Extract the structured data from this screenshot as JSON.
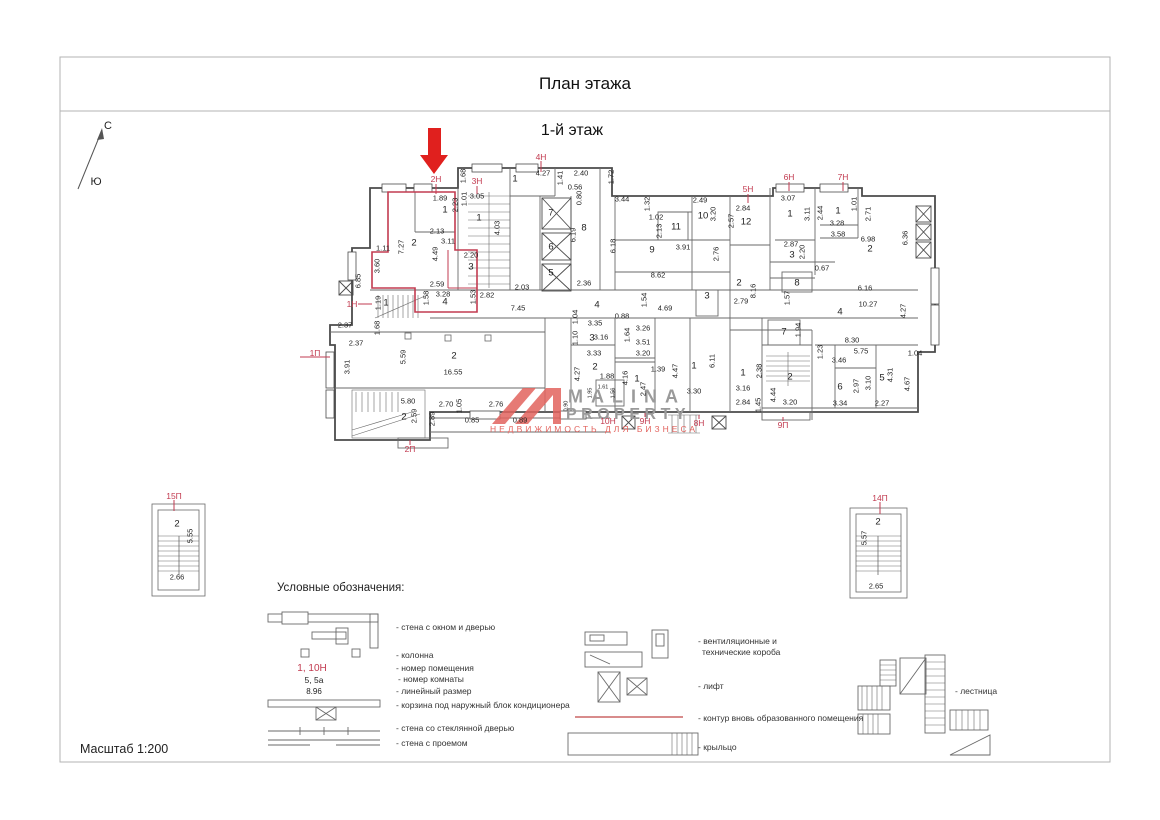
{
  "title": "План этажа",
  "floor_label": "1-й этаж",
  "scale_label": "Масштаб 1:200",
  "compass": {
    "north": "С",
    "south": "Ю"
  },
  "colors": {
    "highlight_red": "#c23b50",
    "wall": "#4b4b4b",
    "watermark_gray": "#9a9a9a",
    "watermark_red": "#e2635e"
  },
  "watermark": {
    "brand_top": "MALINA",
    "brand_bottom": "PROPERTY",
    "tagline": "НЕДВИЖИМОСТЬ ДЛЯ БИЗНЕСА"
  },
  "plan": {
    "unit_labels": [
      {
        "t": "2Н",
        "x": 436,
        "y": 179
      },
      {
        "t": "3Н",
        "x": 477,
        "y": 181
      },
      {
        "t": "4Н",
        "x": 541,
        "y": 157
      },
      {
        "t": "5Н",
        "x": 748,
        "y": 189
      },
      {
        "t": "6Н",
        "x": 789,
        "y": 177
      },
      {
        "t": "7Н",
        "x": 843,
        "y": 177
      },
      {
        "t": "1Н",
        "x": 352,
        "y": 304
      },
      {
        "t": "1П",
        "x": 315,
        "y": 353
      },
      {
        "t": "2П",
        "x": 410,
        "y": 449
      },
      {
        "t": "10Н",
        "x": 608,
        "y": 421
      },
      {
        "t": "9Н",
        "x": 645,
        "y": 421
      },
      {
        "t": "8Н",
        "x": 699,
        "y": 423
      },
      {
        "t": "9П",
        "x": 783,
        "y": 425
      },
      {
        "t": "15П",
        "x": 174,
        "y": 496
      },
      {
        "t": "14П",
        "x": 880,
        "y": 498
      }
    ],
    "room_numbers": [
      {
        "t": "1",
        "x": 445,
        "y": 210
      },
      {
        "t": "2",
        "x": 414,
        "y": 243
      },
      {
        "t": "3",
        "x": 471,
        "y": 267
      },
      {
        "t": "4",
        "x": 445,
        "y": 302
      },
      {
        "t": "1",
        "x": 479,
        "y": 218
      },
      {
        "t": "1",
        "x": 515,
        "y": 179
      },
      {
        "t": "7",
        "x": 551,
        "y": 213
      },
      {
        "t": "6",
        "x": 551,
        "y": 247
      },
      {
        "t": "5",
        "x": 551,
        "y": 273
      },
      {
        "t": "8",
        "x": 584,
        "y": 228
      },
      {
        "t": "9",
        "x": 652,
        "y": 250
      },
      {
        "t": "11",
        "x": 676,
        "y": 227
      },
      {
        "t": "10",
        "x": 703,
        "y": 216
      },
      {
        "t": "12",
        "x": 746,
        "y": 222
      },
      {
        "t": "1",
        "x": 790,
        "y": 214
      },
      {
        "t": "1",
        "x": 838,
        "y": 211
      },
      {
        "t": "2",
        "x": 870,
        "y": 249
      },
      {
        "t": "3",
        "x": 792,
        "y": 255
      },
      {
        "t": "8",
        "x": 797,
        "y": 283
      },
      {
        "t": "2",
        "x": 739,
        "y": 283
      },
      {
        "t": "4",
        "x": 597,
        "y": 305
      },
      {
        "t": "3",
        "x": 592,
        "y": 338
      },
      {
        "t": "2",
        "x": 595,
        "y": 367
      },
      {
        "t": "1",
        "x": 637,
        "y": 379
      },
      {
        "t": "1",
        "x": 694,
        "y": 366
      },
      {
        "t": "3",
        "x": 707,
        "y": 296
      },
      {
        "t": "7",
        "x": 784,
        "y": 332
      },
      {
        "t": "4",
        "x": 840,
        "y": 312
      },
      {
        "t": "1",
        "x": 743,
        "y": 373
      },
      {
        "t": "2",
        "x": 790,
        "y": 377
      },
      {
        "t": "6",
        "x": 840,
        "y": 387
      },
      {
        "t": "5",
        "x": 882,
        "y": 378
      },
      {
        "t": "2",
        "x": 454,
        "y": 356
      },
      {
        "t": "2",
        "x": 404,
        "y": 417
      },
      {
        "t": "1",
        "x": 386,
        "y": 303
      },
      {
        "t": "2",
        "x": 177,
        "y": 524
      },
      {
        "t": "2",
        "x": 878,
        "y": 522
      }
    ],
    "dims_h": [
      {
        "t": "1.89",
        "x": 440,
        "y": 198
      },
      {
        "t": "3.05",
        "x": 477,
        "y": 196
      },
      {
        "t": "2.13",
        "x": 437,
        "y": 231
      },
      {
        "t": "3.11",
        "x": 448,
        "y": 241
      },
      {
        "t": "4.27",
        "x": 543,
        "y": 173
      },
      {
        "t": "2.40",
        "x": 581,
        "y": 173
      },
      {
        "t": "0.56",
        "x": 575,
        "y": 187
      },
      {
        "t": "3.44",
        "x": 622,
        "y": 199
      },
      {
        "t": "2.49",
        "x": 700,
        "y": 200
      },
      {
        "t": "1.02",
        "x": 656,
        "y": 217
      },
      {
        "t": "3.91",
        "x": 683,
        "y": 247
      },
      {
        "t": "2.84",
        "x": 743,
        "y": 208
      },
      {
        "t": "3.07",
        "x": 788,
        "y": 198
      },
      {
        "t": "3.28",
        "x": 837,
        "y": 223
      },
      {
        "t": "3.58",
        "x": 838,
        "y": 234
      },
      {
        "t": "6.98",
        "x": 868,
        "y": 239
      },
      {
        "t": "2.87",
        "x": 791,
        "y": 244
      },
      {
        "t": "0.67",
        "x": 822,
        "y": 268
      },
      {
        "t": "8.62",
        "x": 658,
        "y": 275
      },
      {
        "t": "2.36",
        "x": 584,
        "y": 283
      },
      {
        "t": "2.03",
        "x": 522,
        "y": 287
      },
      {
        "t": "2.59",
        "x": 437,
        "y": 284
      },
      {
        "t": "3.28",
        "x": 443,
        "y": 294
      },
      {
        "t": "2.82",
        "x": 487,
        "y": 295
      },
      {
        "t": "7.45",
        "x": 518,
        "y": 308
      },
      {
        "t": "2.20",
        "x": 471,
        "y": 255
      },
      {
        "t": "1.11",
        "x": 383,
        "y": 248
      },
      {
        "t": "2.37",
        "x": 345,
        "y": 325
      },
      {
        "t": "2.37",
        "x": 356,
        "y": 343
      },
      {
        "t": "16.55",
        "x": 453,
        "y": 372
      },
      {
        "t": "5.80",
        "x": 408,
        "y": 401
      },
      {
        "t": "2.70",
        "x": 446,
        "y": 404
      },
      {
        "t": "0.85",
        "x": 472,
        "y": 420
      },
      {
        "t": "2.76",
        "x": 496,
        "y": 404
      },
      {
        "t": "0.89",
        "x": 520,
        "y": 420
      },
      {
        "t": "4.69",
        "x": 665,
        "y": 308
      },
      {
        "t": "0.88",
        "x": 622,
        "y": 316
      },
      {
        "t": "3.35",
        "x": 595,
        "y": 323
      },
      {
        "t": "3.26",
        "x": 643,
        "y": 328
      },
      {
        "t": "3.51",
        "x": 643,
        "y": 342
      },
      {
        "t": "3.16",
        "x": 601,
        "y": 337
      },
      {
        "t": "3.33",
        "x": 594,
        "y": 353
      },
      {
        "t": "3.20",
        "x": 643,
        "y": 353
      },
      {
        "t": "1.88",
        "x": 607,
        "y": 376
      },
      {
        "t": "1.39",
        "x": 658,
        "y": 369
      },
      {
        "t": "3.30",
        "x": 694,
        "y": 391
      },
      {
        "t": "3.46",
        "x": 839,
        "y": 360
      },
      {
        "t": "5.75",
        "x": 861,
        "y": 351
      },
      {
        "t": "8.30",
        "x": 852,
        "y": 340
      },
      {
        "t": "6.16",
        "x": 865,
        "y": 288
      },
      {
        "t": "10.27",
        "x": 868,
        "y": 304
      },
      {
        "t": "3.16",
        "x": 743,
        "y": 388
      },
      {
        "t": "2.84",
        "x": 743,
        "y": 402
      },
      {
        "t": "3.20",
        "x": 790,
        "y": 402
      },
      {
        "t": "3.34",
        "x": 840,
        "y": 403
      },
      {
        "t": "2.27",
        "x": 882,
        "y": 403
      },
      {
        "t": "1.04",
        "x": 915,
        "y": 353
      },
      {
        "t": "2.79",
        "x": 741,
        "y": 301
      },
      {
        "t": "2.66",
        "x": 177,
        "y": 577
      },
      {
        "t": "2.65",
        "x": 876,
        "y": 586
      }
    ],
    "dims_v": [
      {
        "t": "2.23",
        "x": 455,
        "y": 205
      },
      {
        "t": "1.01",
        "x": 464,
        "y": 199
      },
      {
        "t": "4.03",
        "x": 497,
        "y": 228
      },
      {
        "t": "1.68",
        "x": 463,
        "y": 176
      },
      {
        "t": "1.41",
        "x": 560,
        "y": 178
      },
      {
        "t": "1.72",
        "x": 611,
        "y": 177
      },
      {
        "t": "0.80",
        "x": 579,
        "y": 198
      },
      {
        "t": "6.19",
        "x": 573,
        "y": 235
      },
      {
        "t": "6.18",
        "x": 613,
        "y": 246
      },
      {
        "t": "1.32",
        "x": 647,
        "y": 204
      },
      {
        "t": "2.13",
        "x": 659,
        "y": 231
      },
      {
        "t": "3.20",
        "x": 713,
        "y": 214
      },
      {
        "t": "2.76",
        "x": 716,
        "y": 254
      },
      {
        "t": "2.57",
        "x": 731,
        "y": 221
      },
      {
        "t": "3.11",
        "x": 807,
        "y": 214
      },
      {
        "t": "2.44",
        "x": 820,
        "y": 213
      },
      {
        "t": "1.01",
        "x": 854,
        "y": 204
      },
      {
        "t": "2.71",
        "x": 868,
        "y": 214
      },
      {
        "t": "6.36",
        "x": 905,
        "y": 238
      },
      {
        "t": "2.20",
        "x": 802,
        "y": 252
      },
      {
        "t": "8.16",
        "x": 753,
        "y": 291
      },
      {
        "t": "1.57",
        "x": 787,
        "y": 298
      },
      {
        "t": "4.27",
        "x": 903,
        "y": 311
      },
      {
        "t": "7.27",
        "x": 401,
        "y": 247
      },
      {
        "t": "4.49",
        "x": 435,
        "y": 254
      },
      {
        "t": "3.60",
        "x": 377,
        "y": 266
      },
      {
        "t": "6.85",
        "x": 358,
        "y": 281
      },
      {
        "t": "1.58",
        "x": 426,
        "y": 298
      },
      {
        "t": "1.53",
        "x": 473,
        "y": 297
      },
      {
        "t": "1.19",
        "x": 378,
        "y": 303
      },
      {
        "t": "1.68",
        "x": 377,
        "y": 328
      },
      {
        "t": "3.91",
        "x": 347,
        "y": 367
      },
      {
        "t": "5.59",
        "x": 403,
        "y": 357
      },
      {
        "t": "2.59",
        "x": 414,
        "y": 416
      },
      {
        "t": "2.89",
        "x": 432,
        "y": 419
      },
      {
        "t": "1.05",
        "x": 459,
        "y": 406
      },
      {
        "t": "1.04",
        "x": 575,
        "y": 317
      },
      {
        "t": "1.10",
        "x": 575,
        "y": 338
      },
      {
        "t": "4.27",
        "x": 577,
        "y": 374
      },
      {
        "t": "1.64",
        "x": 627,
        "y": 335
      },
      {
        "t": "4.16",
        "x": 625,
        "y": 378
      },
      {
        "t": "2.47",
        "x": 643,
        "y": 389
      },
      {
        "t": "4.47",
        "x": 675,
        "y": 371
      },
      {
        "t": "6.11",
        "x": 712,
        "y": 361
      },
      {
        "t": "1.54",
        "x": 644,
        "y": 300
      },
      {
        "t": "2.38",
        "x": 759,
        "y": 371
      },
      {
        "t": "1.45",
        "x": 758,
        "y": 405
      },
      {
        "t": "4.44",
        "x": 773,
        "y": 395
      },
      {
        "t": "1.23",
        "x": 820,
        "y": 352
      },
      {
        "t": "2.97",
        "x": 856,
        "y": 386
      },
      {
        "t": "3.10",
        "x": 868,
        "y": 383
      },
      {
        "t": "4.31",
        "x": 890,
        "y": 375
      },
      {
        "t": "4.67",
        "x": 907,
        "y": 384
      },
      {
        "t": "1.94",
        "x": 798,
        "y": 330
      },
      {
        "t": "5.55",
        "x": 190,
        "y": 536
      },
      {
        "t": "5.57",
        "x": 864,
        "y": 538
      }
    ],
    "dims_tiny": [
      {
        "t": "1.61",
        "x": 603,
        "y": 388
      },
      {
        "t": "1.95",
        "x": 591,
        "y": 393,
        "r": 1
      },
      {
        "t": "1.56",
        "x": 614,
        "y": 393,
        "r": 1
      },
      {
        "t": "0.90",
        "x": 567,
        "y": 406,
        "r": 1
      }
    ]
  },
  "legend": {
    "title": "Условные обозначения:",
    "sample_unit": "1, 10Н",
    "sample_room": "5, 5а",
    "sample_dim": "8.96",
    "left_items": [
      {
        "t": "- стена с  окном и дверью",
        "x": 396,
        "y": 627
      },
      {
        "t": "- колонна",
        "x": 396,
        "y": 655
      },
      {
        "t": "- номер помещения",
        "x": 396,
        "y": 668
      },
      {
        "t": "- номер  комнаты",
        "x": 398,
        "y": 679
      },
      {
        "t": "- линейный размер",
        "x": 396,
        "y": 691
      },
      {
        "t": "- корзина под наружный блок кондиционера",
        "x": 396,
        "y": 705
      },
      {
        "t": "- стена со стеклянной  дверью",
        "x": 396,
        "y": 728
      },
      {
        "t": "- стена с  проемом",
        "x": 396,
        "y": 743
      }
    ],
    "right_items": [
      {
        "t": "- вентиляционные и",
        "x": 698,
        "y": 641
      },
      {
        "t": "технические короба",
        "x": 702,
        "y": 652
      },
      {
        "t": "- лифт",
        "x": 698,
        "y": 686
      },
      {
        "t": "- контур вновь образованного помещения",
        "x": 698,
        "y": 718
      },
      {
        "t": "- крыльцо",
        "x": 698,
        "y": 747
      },
      {
        "t": "- лестница",
        "x": 955,
        "y": 691
      }
    ]
  }
}
